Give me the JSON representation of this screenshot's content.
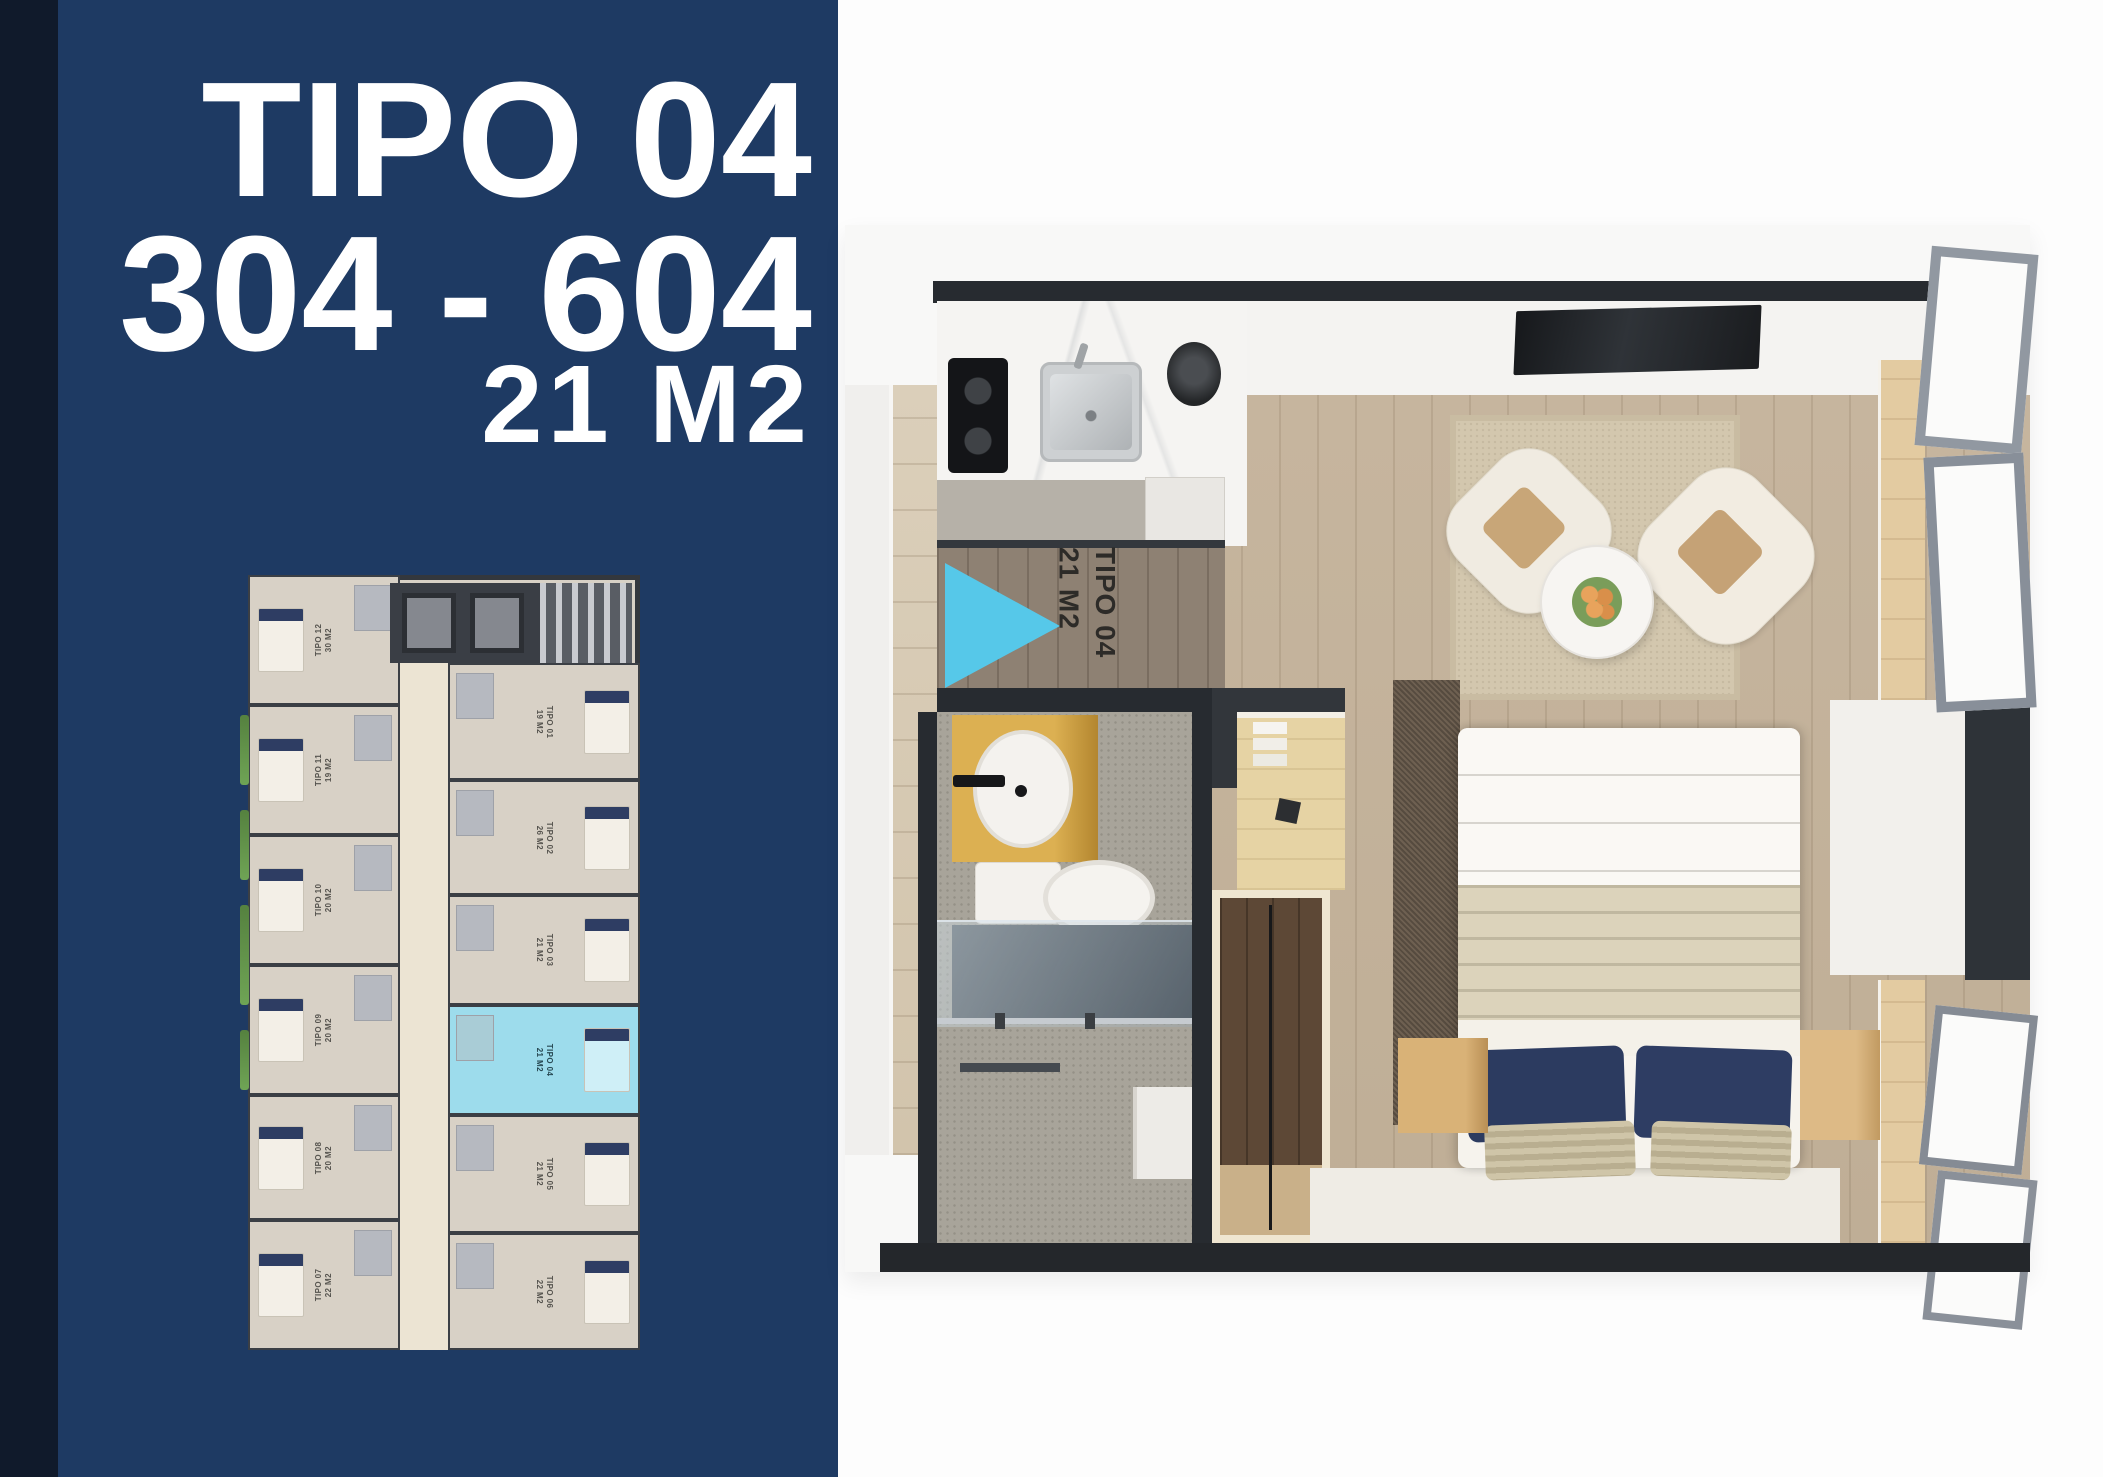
{
  "page": {
    "background": "#fdfdfd"
  },
  "colors": {
    "dark_strip": "#101a2b",
    "sidebar_navy": "#1e3a63",
    "accent_cyan": "#59c7e8",
    "keyplan_highlight": "#9ddcec",
    "title_text": "#ffffff"
  },
  "sidebar": {
    "title_line1": "TIPO 04",
    "title_line2": "304 - 604",
    "title_line3": "21 M2"
  },
  "key_plan": {
    "units": [
      {
        "tipo": "TIPO 12",
        "area": "30 M2",
        "highlighted": false
      },
      {
        "tipo": "TIPO 11",
        "area": "19 M2",
        "highlighted": false
      },
      {
        "tipo": "TIPO 10",
        "area": "20 M2",
        "highlighted": false
      },
      {
        "tipo": "TIPO 09",
        "area": "20 M2",
        "highlighted": false
      },
      {
        "tipo": "TIPO 08",
        "area": "20 M2",
        "highlighted": false
      },
      {
        "tipo": "TIPO 07",
        "area": "22 M2",
        "highlighted": false
      },
      {
        "tipo": "TIPO 01",
        "area": "19 M2",
        "highlighted": false
      },
      {
        "tipo": "TIPO 02",
        "area": "26 M2",
        "highlighted": false
      },
      {
        "tipo": "TIPO 03",
        "area": "21 M2",
        "highlighted": false
      },
      {
        "tipo": "TIPO 04",
        "area": "21 M2",
        "highlighted": true
      },
      {
        "tipo": "TIPO 05",
        "area": "21 M2",
        "highlighted": false
      },
      {
        "tipo": "TIPO 06",
        "area": "22 M2",
        "highlighted": false
      }
    ]
  },
  "render": {
    "unit_label_tipo": "TIPO 04",
    "unit_label_area": "21 M2"
  }
}
